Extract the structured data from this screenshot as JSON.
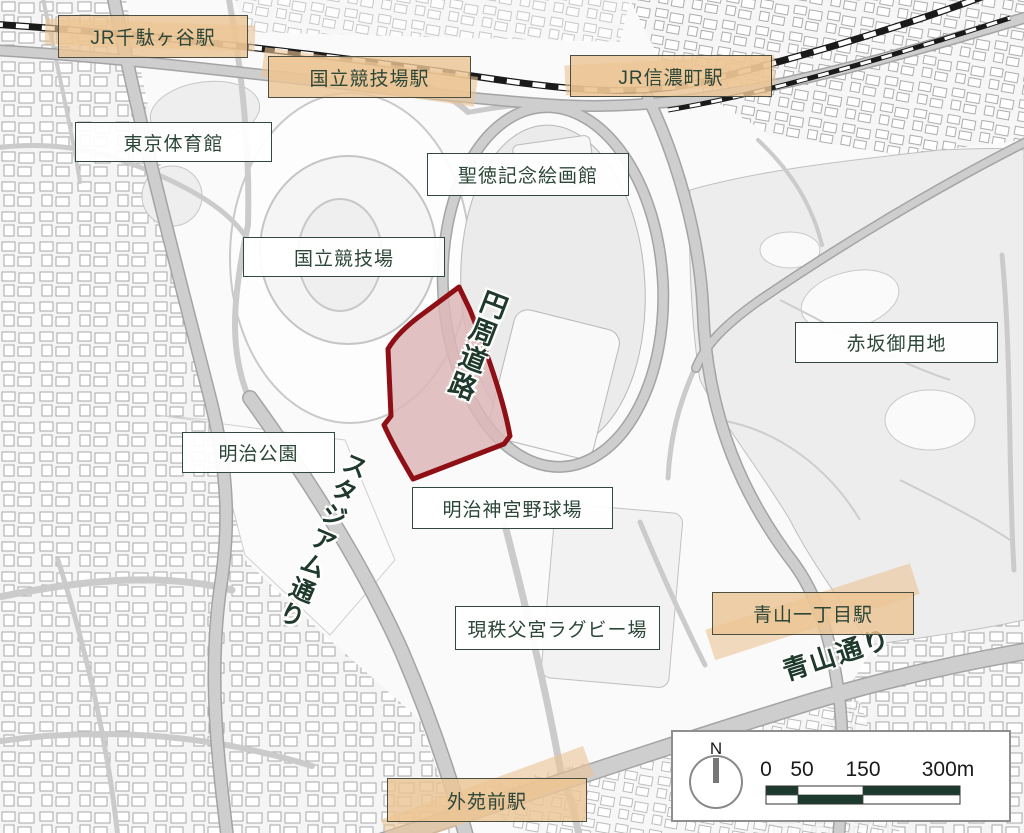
{
  "colors": {
    "label-text": "#2c4638",
    "station-fill": "#ecc494",
    "station-border": "#4b4f41",
    "facility-border": "#32483e",
    "site-fill": "#dcb6b6",
    "site-stroke": "#8e1016",
    "road-label": "#1f3a2d",
    "scale-dark": "#1c3a2e"
  },
  "stations": [
    {
      "label": "JR千駄ヶ谷駅"
    },
    {
      "label": "国立競技場駅"
    },
    {
      "label": "JR信濃町駅"
    },
    {
      "label": "青山一丁目駅"
    },
    {
      "label": "外苑前駅"
    }
  ],
  "facilities": [
    {
      "label": "東京体育館"
    },
    {
      "label": "聖徳記念絵画館"
    },
    {
      "label": "国立競技場"
    },
    {
      "label": "赤坂御用地"
    },
    {
      "label": "明治公園"
    },
    {
      "label": "明治神宮野球場"
    },
    {
      "label": "現秩父宮ラグビー場"
    }
  ],
  "roads": {
    "enshu_doro": "円周道路",
    "stadium_dori": "スタジアム通り",
    "aoyama_dori": "青山通り"
  },
  "scale": {
    "north": "N",
    "ticks": [
      "0",
      "50",
      "150",
      "300m"
    ]
  }
}
